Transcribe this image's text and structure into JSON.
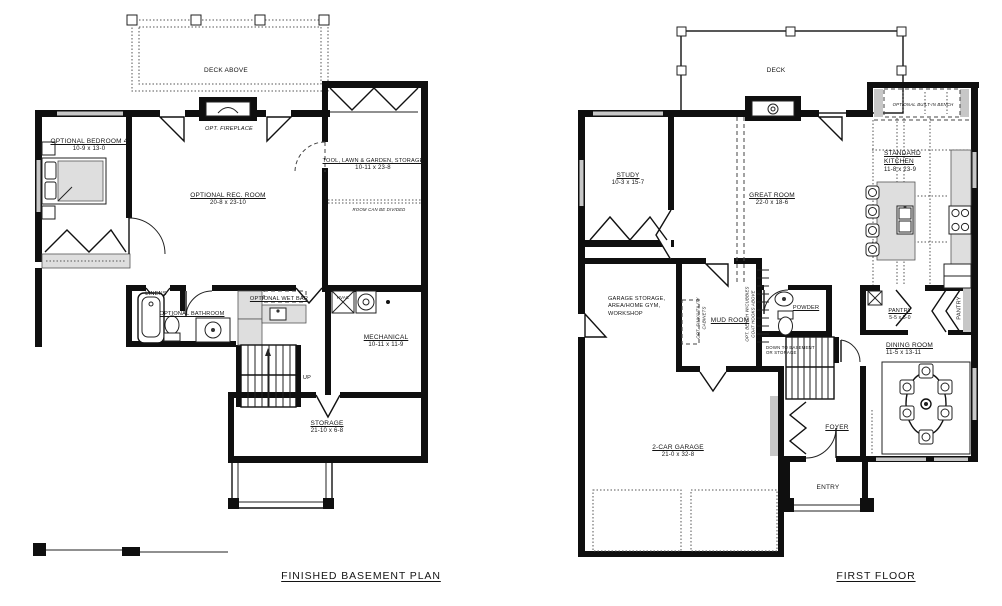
{
  "drawing": {
    "background": "#ffffff",
    "wall_color": "#0f0f0f",
    "window_color": "#c7c7c7"
  },
  "basement": {
    "title": "FINISHED BASEMENT PLAN",
    "deck_label": "DECK ABOVE",
    "fireplace_label": "OPT. FIREPLACE",
    "bedroom4_name": "OPTIONAL BEDROOM 4",
    "bedroom4_dims": "10-9 x 13-0",
    "rec_room_name": "OPTIONAL REC. ROOM",
    "rec_room_dims": "20-8 x 23-10",
    "tool_room_name": "TOOL, LAWN & GARDEN, STORAGE",
    "tool_room_dims": "10-11 x 23-8",
    "tool_room_note": "ROOM CAN BE DIVIDED",
    "linens_label": "LINENS",
    "bathroom_label": "OPTIONAL BATHROOM",
    "wet_bar_label": "OPTIONAL WET BAR",
    "hvac_label": "HVAC",
    "mechanical_name": "MECHANICAL",
    "mechanical_dims": "10-11 x 11-9",
    "stairs_label": "UP",
    "storage_name": "STORAGE",
    "storage_dims": "21-10 x 6-8"
  },
  "first_floor": {
    "title": "FIRST FLOOR",
    "deck_label": "DECK",
    "bench_note": "OPTIONAL BUILT-IN BENCH",
    "study_name": "STUDY",
    "study_dims": "10-3 x 15-7",
    "great_room_name": "GREAT ROOM",
    "great_room_dims": "22-0 x 18-6",
    "kitchen_name": "STANDARD KITCHEN",
    "kitchen_dims": "11-8 x 23-9",
    "garage_storage_note": "GARAGE STORAGE,\nAREA/HOME GYM,\nWORKSHOP",
    "mud_room_label": "MUD ROOM",
    "sink_cabinet_note": "OPT. SINK/UTILITY\nCABINETS",
    "bench_cubbies_note": "OPT. BENCH W/CUBBIES\nCOAT HOOKS ABOVE",
    "powder_label": "POWDER",
    "stairs_note": "DOWN TO BASEMENT\nOR STORAGE",
    "pantry_name": "PANTRY",
    "pantry_dims": "5-5 x 5-0",
    "pantry2_label": "PANTRY",
    "dining_name": "DINING ROOM",
    "dining_dims": "11-5 x 13-11",
    "foyer_label": "FOYER",
    "entry_label": "ENTRY",
    "garage_name": "2-CAR GARAGE",
    "garage_dims": "21-0 x 32-8"
  }
}
